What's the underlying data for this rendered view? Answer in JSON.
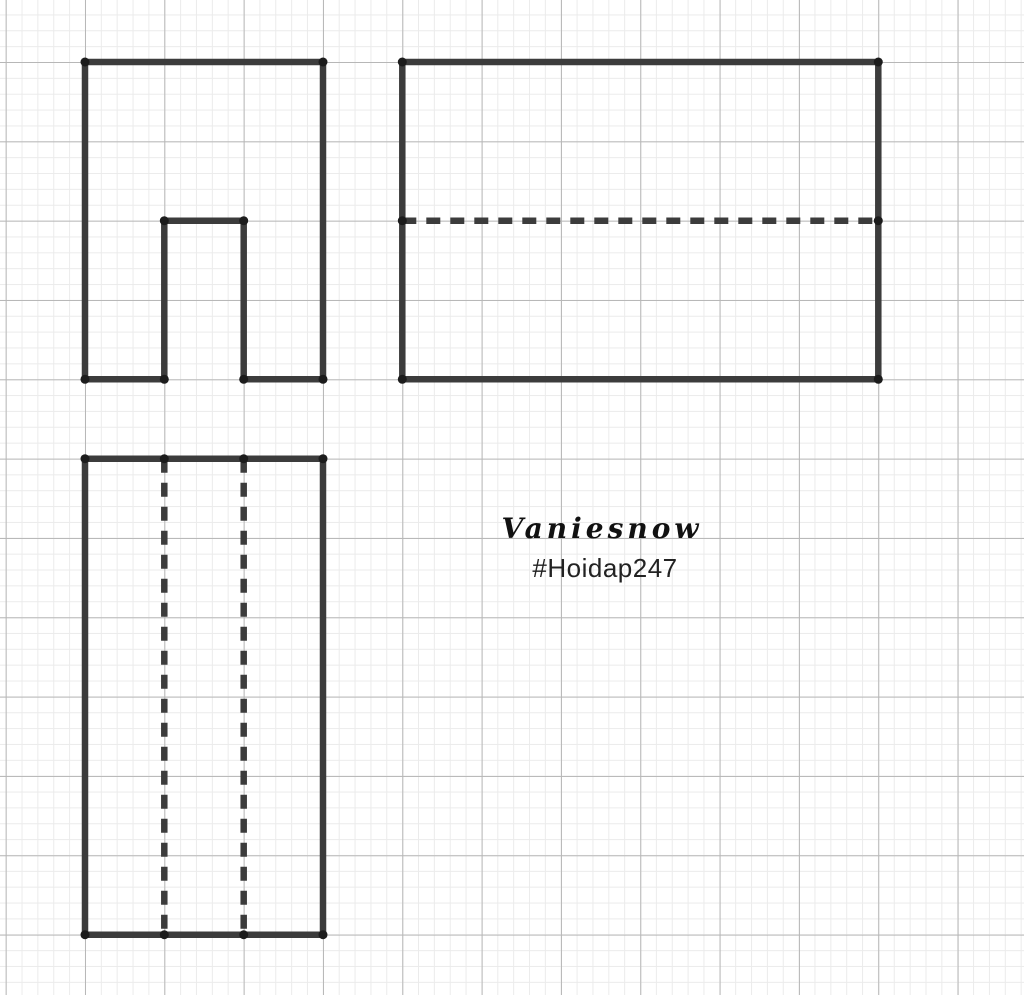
{
  "watermark": {
    "title": "Vaniesnow",
    "subtitle": "#Hoidap247"
  },
  "canvas": {
    "width": 1024,
    "height": 995,
    "background": "#ffffff",
    "grid": {
      "major_color": "#b7b7b7",
      "minor_color": "#ebebeb",
      "major_spacing": 79.33,
      "minor_spacing": 15.867,
      "major_offset_x": 5.67,
      "major_offset_y": 62
    }
  },
  "drawing": {
    "stroke_color": "#3c3c3c",
    "stroke_width": 6.5,
    "dash_pattern": "14 10",
    "point_color": "#1c1c1c",
    "point_radius": 4.5,
    "shapes": [
      {
        "id": "front-view",
        "paths": [
          {
            "type": "polygon",
            "dashed": false,
            "points": [
              [
                85,
                62
              ],
              [
                323,
                62
              ],
              [
                323,
                379.3
              ],
              [
                243.7,
                379.3
              ],
              [
                243.7,
                220.7
              ],
              [
                164.3,
                220.7
              ],
              [
                164.3,
                379.3
              ],
              [
                85,
                379.3
              ]
            ]
          }
        ],
        "vertices": [
          [
            85,
            62
          ],
          [
            323,
            62
          ],
          [
            164.3,
            220.7
          ],
          [
            243.7,
            220.7
          ],
          [
            85,
            379.3
          ],
          [
            164.3,
            379.3
          ],
          [
            243.7,
            379.3
          ],
          [
            323,
            379.3
          ]
        ]
      },
      {
        "id": "side-view",
        "paths": [
          {
            "type": "polygon",
            "dashed": false,
            "points": [
              [
                402.3,
                62
              ],
              [
                878.3,
                62
              ],
              [
                878.3,
                379.3
              ],
              [
                402.3,
                379.3
              ]
            ]
          },
          {
            "type": "line",
            "dashed": true,
            "points": [
              [
                402.3,
                220.7
              ],
              [
                878.3,
                220.7
              ]
            ]
          }
        ],
        "vertices": [
          [
            402.3,
            62
          ],
          [
            878.3,
            62
          ],
          [
            402.3,
            220.7
          ],
          [
            878.3,
            220.7
          ],
          [
            402.3,
            379.3
          ],
          [
            878.3,
            379.3
          ]
        ]
      },
      {
        "id": "top-view",
        "paths": [
          {
            "type": "polygon",
            "dashed": false,
            "points": [
              [
                85,
                458.7
              ],
              [
                323,
                458.7
              ],
              [
                323,
                934.7
              ],
              [
                85,
                934.7
              ]
            ]
          },
          {
            "type": "line",
            "dashed": true,
            "points": [
              [
                164.3,
                458.7
              ],
              [
                164.3,
                934.7
              ]
            ]
          },
          {
            "type": "line",
            "dashed": true,
            "points": [
              [
                243.7,
                458.7
              ],
              [
                243.7,
                934.7
              ]
            ]
          }
        ],
        "vertices": [
          [
            85,
            458.7
          ],
          [
            164.3,
            458.7
          ],
          [
            243.7,
            458.7
          ],
          [
            323,
            458.7
          ],
          [
            85,
            934.7
          ],
          [
            164.3,
            934.7
          ],
          [
            243.7,
            934.7
          ],
          [
            323,
            934.7
          ]
        ]
      }
    ]
  }
}
